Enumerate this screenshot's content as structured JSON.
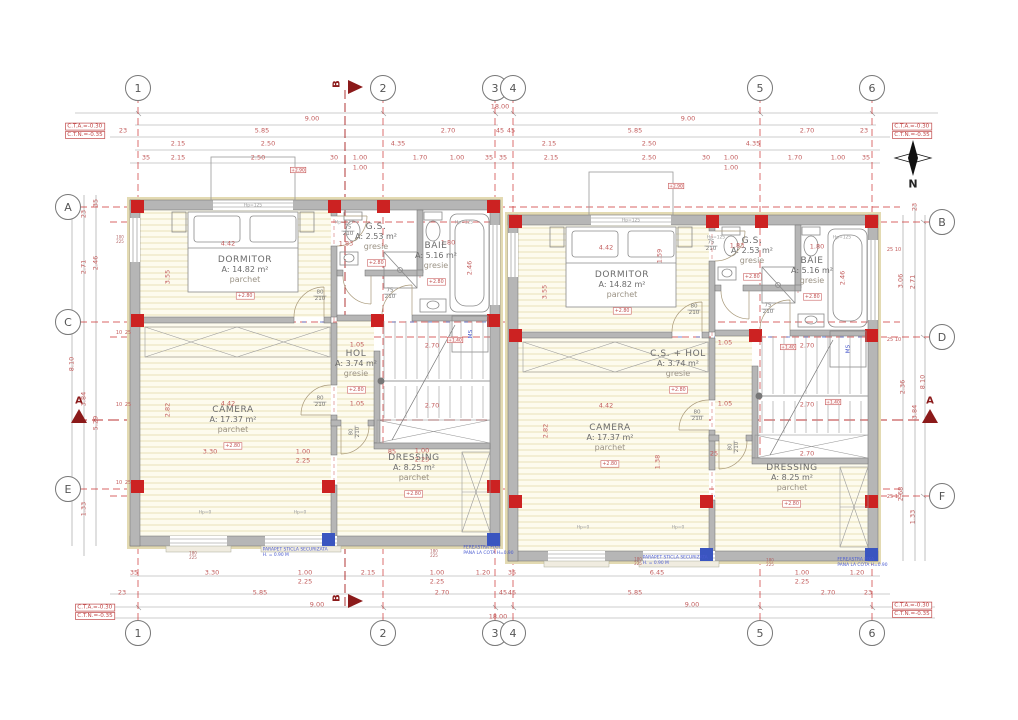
{
  "north_label": "N",
  "grid": {
    "top_y": 88,
    "bottom_y": 633,
    "left_x": 68,
    "right_x": 942,
    "top": [
      {
        "label": "1",
        "x": 138
      },
      {
        "label": "2",
        "x": 383
      },
      {
        "label": "3",
        "x": 495
      },
      {
        "label": "4",
        "x": 513
      },
      {
        "label": "5",
        "x": 760
      },
      {
        "label": "6",
        "x": 872
      }
    ],
    "left": [
      {
        "label": "A",
        "y": 207
      },
      {
        "label": "C",
        "y": 322
      },
      {
        "label": "E",
        "y": 489
      }
    ],
    "right": [
      {
        "label": "B",
        "y": 222
      },
      {
        "label": "D",
        "y": 337
      },
      {
        "label": "F",
        "y": 496
      }
    ]
  },
  "section_markers": [
    {
      "letter": "B",
      "x": 337,
      "y": 84,
      "r": 90
    },
    {
      "letter": "B",
      "x": 337,
      "y": 598,
      "r": 90
    },
    {
      "letter": "A",
      "x": 79,
      "y": 401
    },
    {
      "letter": "A",
      "x": 930,
      "y": 401
    }
  ],
  "corner_notes": [
    {
      "lines": [
        "C.T.A.=-0.30",
        "C.T.N.=-0.35"
      ],
      "x": 85,
      "y": 131
    },
    {
      "lines": [
        "C.T.A.=-0.30",
        "C.T.N.=-0.35"
      ],
      "x": 912,
      "y": 131
    },
    {
      "lines": [
        "C.T.A.=-0.30",
        "C.T.N.=-0.35"
      ],
      "x": 95,
      "y": 612
    },
    {
      "lines": [
        "C.T.A.=-0.30",
        "C.T.N.=-0.35"
      ],
      "x": 912,
      "y": 610
    }
  ],
  "rooms": [
    {
      "name": "DORMITOR",
      "area": "A: 14.82 m²",
      "floor": "parchet",
      "elev": "+2.80",
      "x": 245,
      "y": 262
    },
    {
      "name": "G.S.",
      "area": "A: 2.53 m²",
      "floor": "gresie",
      "elev": "+2.80",
      "x": 376,
      "y": 229
    },
    {
      "name": "BAIE",
      "area": "A: 5.16 m²",
      "floor": "gresie",
      "elev": "+2.80",
      "x": 436,
      "y": 248
    },
    {
      "name": "HOL",
      "area": "A: 3.74 m²",
      "floor": "gresie",
      "elev": "+2.80",
      "x": 356,
      "y": 356
    },
    {
      "name": "CAMERA",
      "area": "A: 17.37 m²",
      "floor": "parchet",
      "elev": "+2.80",
      "x": 233,
      "y": 412
    },
    {
      "name": "DRESSING",
      "area": "A: 8.25 m²",
      "floor": "parchet",
      "elev": "+2.80",
      "x": 414,
      "y": 460
    },
    {
      "name": "DORMITOR",
      "area": "A: 14.82 m²",
      "floor": "parchet",
      "elev": "+2.80",
      "x": 622,
      "y": 277
    },
    {
      "name": "G.S.",
      "area": "A: 2.53 m²",
      "floor": "gresie",
      "elev": "+2.80",
      "x": 752,
      "y": 243
    },
    {
      "name": "BAIE",
      "area": "A: 5.16 m²",
      "floor": "gresie",
      "elev": "+2.80",
      "x": 812,
      "y": 263
    },
    {
      "name": "C.S. + HOL",
      "area": "A: 3.74 m²",
      "floor": "gresie",
      "elev": "+2.80",
      "x": 678,
      "y": 356
    },
    {
      "name": "CAMERA",
      "area": "A: 17.37 m²",
      "floor": "parchet",
      "elev": "+2.80",
      "x": 610,
      "y": 430
    },
    {
      "name": "DRESSING",
      "area": "A: 8.25 m²",
      "floor": "parchet",
      "elev": "+2.80",
      "x": 792,
      "y": 470
    }
  ],
  "dimensions": [
    {
      "t": "18.00",
      "x": 500,
      "y": 107
    },
    {
      "t": "9.00",
      "x": 312,
      "y": 119
    },
    {
      "t": "9.00",
      "x": 688,
      "y": 119
    },
    {
      "t": "23",
      "x": 123,
      "y": 131
    },
    {
      "t": "5.85",
      "x": 262,
      "y": 131
    },
    {
      "t": "2.70",
      "x": 448,
      "y": 131
    },
    {
      "t": "45",
      "x": 500,
      "y": 131
    },
    {
      "t": "45",
      "x": 511,
      "y": 131
    },
    {
      "t": "5.85",
      "x": 635,
      "y": 131
    },
    {
      "t": "2.70",
      "x": 807,
      "y": 131
    },
    {
      "t": "23",
      "x": 864,
      "y": 131
    },
    {
      "t": "2.15",
      "x": 178,
      "y": 144
    },
    {
      "t": "2.50",
      "x": 268,
      "y": 144
    },
    {
      "t": "4.35",
      "x": 398,
      "y": 144
    },
    {
      "t": "2.15",
      "x": 549,
      "y": 144
    },
    {
      "t": "2.50",
      "x": 649,
      "y": 144
    },
    {
      "t": "4.35",
      "x": 753,
      "y": 144
    },
    {
      "t": "35",
      "x": 146,
      "y": 158
    },
    {
      "t": "2.15",
      "x": 178,
      "y": 158
    },
    {
      "t": "2.50",
      "x": 258,
      "y": 158
    },
    {
      "t": "30",
      "x": 334,
      "y": 158
    },
    {
      "t": "1.00",
      "x": 360,
      "y": 158
    },
    {
      "t": "1.70",
      "x": 420,
      "y": 158
    },
    {
      "t": "1.00",
      "x": 457,
      "y": 158
    },
    {
      "t": "35",
      "x": 489,
      "y": 158
    },
    {
      "t": "1.00",
      "x": 360,
      "y": 168
    },
    {
      "t": "35",
      "x": 503,
      "y": 158
    },
    {
      "t": "2.15",
      "x": 551,
      "y": 158
    },
    {
      "t": "2.50",
      "x": 649,
      "y": 158
    },
    {
      "t": "30",
      "x": 706,
      "y": 158
    },
    {
      "t": "1.00",
      "x": 731,
      "y": 158
    },
    {
      "t": "1.70",
      "x": 795,
      "y": 158
    },
    {
      "t": "1.00",
      "x": 838,
      "y": 158
    },
    {
      "t": "35",
      "x": 866,
      "y": 158
    },
    {
      "t": "1.00",
      "x": 731,
      "y": 168
    },
    {
      "t": "35",
      "x": 134,
      "y": 573
    },
    {
      "t": "3.30",
      "x": 212,
      "y": 573
    },
    {
      "t": "1.00",
      "x": 305,
      "y": 573
    },
    {
      "t": "2.15",
      "x": 368,
      "y": 573
    },
    {
      "t": "1.00",
      "x": 437,
      "y": 573
    },
    {
      "t": "1.20",
      "x": 483,
      "y": 573
    },
    {
      "t": "35",
      "x": 512,
      "y": 573
    },
    {
      "t": "2.25",
      "x": 305,
      "y": 582
    },
    {
      "t": "2.25",
      "x": 437,
      "y": 582
    },
    {
      "t": "6.45",
      "x": 657,
      "y": 573
    },
    {
      "t": "1.00",
      "x": 802,
      "y": 573
    },
    {
      "t": "1.20",
      "x": 857,
      "y": 573
    },
    {
      "t": "2.25",
      "x": 802,
      "y": 582
    },
    {
      "t": "23",
      "x": 122,
      "y": 593
    },
    {
      "t": "5.85",
      "x": 260,
      "y": 593
    },
    {
      "t": "2.70",
      "x": 442,
      "y": 593
    },
    {
      "t": "45",
      "x": 503,
      "y": 593
    },
    {
      "t": "45",
      "x": 512,
      "y": 593
    },
    {
      "t": "5.85",
      "x": 635,
      "y": 593
    },
    {
      "t": "2.70",
      "x": 828,
      "y": 593
    },
    {
      "t": "23",
      "x": 868,
      "y": 593
    },
    {
      "t": "9.00",
      "x": 317,
      "y": 605
    },
    {
      "t": "9.00",
      "x": 692,
      "y": 605
    },
    {
      "t": "18.00",
      "x": 498,
      "y": 617
    },
    {
      "t": "35",
      "x": 96,
      "y": 203,
      "r": 90
    },
    {
      "t": "23",
      "x": 84,
      "y": 214,
      "r": 90
    },
    {
      "t": "2.71",
      "x": 84,
      "y": 267,
      "r": 90
    },
    {
      "t": "2.46",
      "x": 96,
      "y": 263,
      "r": 90
    },
    {
      "t": "8.10",
      "x": 72,
      "y": 364,
      "r": 90
    },
    {
      "t": "3.84",
      "x": 84,
      "y": 399,
      "r": 90
    },
    {
      "t": "5.29",
      "x": 96,
      "y": 423,
      "r": 90
    },
    {
      "t": "1.33",
      "x": 84,
      "y": 509,
      "r": 90
    },
    {
      "t": "23",
      "x": 915,
      "y": 207,
      "r": 90
    },
    {
      "t": "3.06",
      "x": 901,
      "y": 281,
      "r": 90
    },
    {
      "t": "2.71",
      "x": 913,
      "y": 282,
      "r": 90
    },
    {
      "t": "8.10",
      "x": 923,
      "y": 382,
      "r": 90
    },
    {
      "t": "2.36",
      "x": 903,
      "y": 387,
      "r": 90
    },
    {
      "t": "3.84",
      "x": 915,
      "y": 412,
      "r": 90
    },
    {
      "t": "2.68",
      "x": 901,
      "y": 494,
      "r": 90
    },
    {
      "t": "1.33",
      "x": 913,
      "y": 517,
      "r": 90
    },
    {
      "t": "4.42",
      "x": 228,
      "y": 244
    },
    {
      "t": "3.55",
      "x": 168,
      "y": 277,
      "r": 90
    },
    {
      "t": "1.83",
      "x": 346,
      "y": 244
    },
    {
      "t": "1.80",
      "x": 448,
      "y": 243
    },
    {
      "t": "2.46",
      "x": 470,
      "y": 268,
      "r": 90
    },
    {
      "t": "1.05",
      "x": 357,
      "y": 345
    },
    {
      "t": "1.05",
      "x": 357,
      "y": 404
    },
    {
      "t": "4.42",
      "x": 228,
      "y": 404
    },
    {
      "t": "2.82",
      "x": 168,
      "y": 410,
      "r": 90
    },
    {
      "t": "3.30",
      "x": 210,
      "y": 452
    },
    {
      "t": "1.00",
      "x": 303,
      "y": 452
    },
    {
      "t": "2.25",
      "x": 303,
      "y": 461
    },
    {
      "t": "2.70",
      "x": 432,
      "y": 346
    },
    {
      "t": "2.70",
      "x": 432,
      "y": 406
    },
    {
      "t": "85",
      "x": 392,
      "y": 452
    },
    {
      "t": "1.00",
      "x": 422,
      "y": 451
    },
    {
      "t": "2.25",
      "x": 422,
      "y": 460
    },
    {
      "t": "4.42",
      "x": 606,
      "y": 248
    },
    {
      "t": "1.59",
      "x": 660,
      "y": 256,
      "r": 90
    },
    {
      "t": "3.55",
      "x": 545,
      "y": 292,
      "r": 90
    },
    {
      "t": "1.83",
      "x": 737,
      "y": 246
    },
    {
      "t": "1.80",
      "x": 817,
      "y": 247
    },
    {
      "t": "2.46",
      "x": 843,
      "y": 278,
      "r": 90
    },
    {
      "t": "1.05",
      "x": 725,
      "y": 343
    },
    {
      "t": "1.05",
      "x": 725,
      "y": 404
    },
    {
      "t": "4.42",
      "x": 606,
      "y": 406
    },
    {
      "t": "2.82",
      "x": 546,
      "y": 431,
      "r": 90
    },
    {
      "t": "1.38",
      "x": 658,
      "y": 462,
      "r": 90
    },
    {
      "t": "2.70",
      "x": 807,
      "y": 346
    },
    {
      "t": "2.70",
      "x": 807,
      "y": 405
    },
    {
      "t": "2.70",
      "x": 807,
      "y": 454
    },
    {
      "t": "25",
      "x": 714,
      "y": 454
    },
    {
      "t": "10",
      "x": 119,
      "y": 333,
      "s": 1
    },
    {
      "t": "25",
      "x": 128,
      "y": 333,
      "s": 1
    },
    {
      "t": "10",
      "x": 119,
      "y": 405,
      "s": 1
    },
    {
      "t": "25",
      "x": 128,
      "y": 405,
      "s": 1
    },
    {
      "t": "10",
      "x": 119,
      "y": 483,
      "s": 1
    },
    {
      "t": "25",
      "x": 128,
      "y": 483,
      "s": 1
    },
    {
      "t": "25",
      "x": 890,
      "y": 250,
      "s": 1
    },
    {
      "t": "10",
      "x": 898,
      "y": 250,
      "s": 1
    },
    {
      "t": "25",
      "x": 890,
      "y": 340,
      "s": 1
    },
    {
      "t": "10",
      "x": 898,
      "y": 340,
      "s": 1
    },
    {
      "t": "25",
      "x": 890,
      "y": 497,
      "s": 1
    },
    {
      "t": "10",
      "x": 898,
      "y": 497,
      "s": 1
    }
  ],
  "door_labels": [
    {
      "n": "75",
      "d": "210",
      "x": 348,
      "y": 231
    },
    {
      "n": "80",
      "d": "210",
      "x": 320,
      "y": 296
    },
    {
      "n": "75",
      "d": "210",
      "x": 390,
      "y": 294
    },
    {
      "n": "80",
      "d": "210",
      "x": 320,
      "y": 402
    },
    {
      "n": "80",
      "d": "210",
      "x": 355,
      "y": 432,
      "r": 90
    },
    {
      "n": "75",
      "d": "210",
      "x": 711,
      "y": 246
    },
    {
      "n": "80",
      "d": "210",
      "x": 694,
      "y": 310
    },
    {
      "n": "75",
      "d": "210",
      "x": 768,
      "y": 309
    },
    {
      "n": "80",
      "d": "210",
      "x": 697,
      "y": 416
    },
    {
      "n": "80",
      "d": "210",
      "x": 734,
      "y": 447,
      "r": 90
    }
  ],
  "window_labels": [
    {
      "t": "Hp=125",
      "x": 344,
      "y": 222
    },
    {
      "t": "Hp=125",
      "x": 464,
      "y": 222
    },
    {
      "t": "Hp=125",
      "x": 716,
      "y": 237
    },
    {
      "t": "Hp=125",
      "x": 842,
      "y": 237
    },
    {
      "t": "Hp=125",
      "x": 253,
      "y": 205
    },
    {
      "t": "Hp=125",
      "x": 631,
      "y": 220
    },
    {
      "t": "Hp=0",
      "x": 205,
      "y": 512
    },
    {
      "t": "Hp=0",
      "x": 300,
      "y": 512
    },
    {
      "t": "Hp=0",
      "x": 583,
      "y": 527
    },
    {
      "t": "Hp=0",
      "x": 678,
      "y": 527
    }
  ],
  "window_sizes": [
    {
      "a": "180",
      "b": "225",
      "x": 193,
      "y": 556
    },
    {
      "a": "180",
      "b": "225",
      "x": 434,
      "y": 554
    },
    {
      "a": "180",
      "b": "225",
      "x": 638,
      "y": 562
    },
    {
      "a": "180",
      "b": "225",
      "x": 770,
      "y": 563
    },
    {
      "a": "100",
      "b": "225",
      "x": 120,
      "y": 240
    }
  ],
  "elev_boxes": [
    {
      "t": "+2.90",
      "x": 298,
      "y": 170
    },
    {
      "t": "+2.90",
      "x": 676,
      "y": 186
    },
    {
      "t": "+1.40",
      "x": 455,
      "y": 340
    },
    {
      "t": "+1.40",
      "x": 788,
      "y": 347
    },
    {
      "t": "+1.40",
      "x": 833,
      "y": 402
    }
  ],
  "machine_labels": [
    {
      "t": "MS",
      "x": 470,
      "y": 334
    },
    {
      "t": "MS",
      "x": 848,
      "y": 349
    }
  ],
  "notes": [
    {
      "lines": [
        "PARAPET STICLA SECURIZATA",
        "H. = 0.90 M"
      ],
      "x": 248,
      "y": 552
    },
    {
      "lines": [
        "FEREASTRA FIXA",
        "PANA LA COTA H=0.90"
      ],
      "x": 452,
      "y": 550
    },
    {
      "lines": [
        "PARAPET STICLA SECURIZATA",
        "H. = 0.90 M"
      ],
      "x": 628,
      "y": 560
    },
    {
      "lines": [
        "FEREASTRA FIXA",
        "PANA LA COTA H=0.90"
      ],
      "x": 826,
      "y": 562
    }
  ]
}
